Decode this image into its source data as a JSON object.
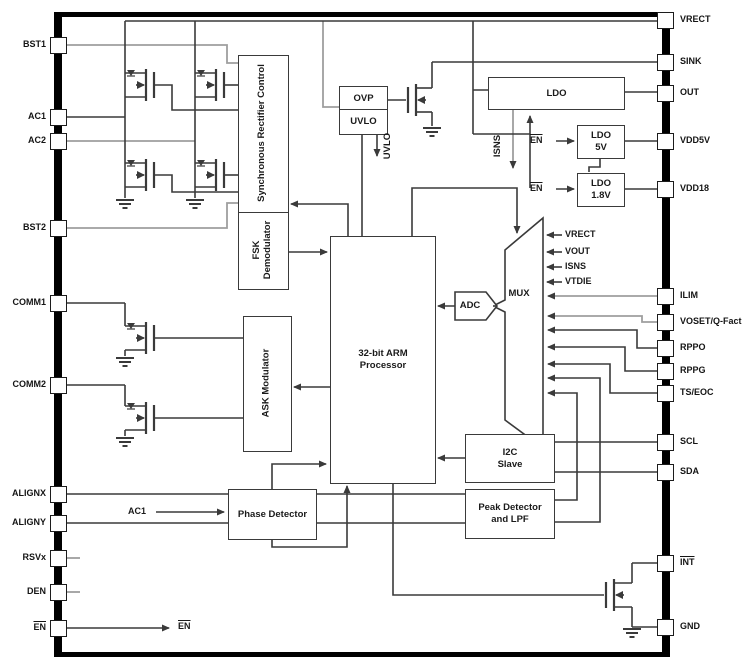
{
  "colors": {
    "line": "#3a3a3a",
    "gray": "#9e9e9e",
    "text": "#1a1a1a",
    "frame": "#000000"
  },
  "pins": {
    "left": [
      {
        "label": "BST1",
        "y": 45,
        "overline": false
      },
      {
        "label": "AC1",
        "y": 117,
        "overline": false
      },
      {
        "label": "AC2",
        "y": 141,
        "overline": false
      },
      {
        "label": "BST2",
        "y": 228,
        "overline": false
      },
      {
        "label": "COMM1",
        "y": 303,
        "overline": false
      },
      {
        "label": "COMM2",
        "y": 385,
        "overline": false
      },
      {
        "label": "ALIGNX",
        "y": 494,
        "overline": false
      },
      {
        "label": "ALIGNY",
        "y": 523,
        "overline": false
      },
      {
        "label": "RSVx",
        "y": 558,
        "overline": false
      },
      {
        "label": "DEN",
        "y": 592,
        "overline": false
      },
      {
        "label": "EN",
        "y": 628,
        "overline": true
      }
    ],
    "right": [
      {
        "label": "VRECT",
        "y": 20,
        "overline": false
      },
      {
        "label": "SINK",
        "y": 62,
        "overline": false
      },
      {
        "label": "OUT",
        "y": 93,
        "overline": false
      },
      {
        "label": "VDD5V",
        "y": 141,
        "overline": false
      },
      {
        "label": "VDD18",
        "y": 189,
        "overline": false
      },
      {
        "label": "ILIM",
        "y": 296,
        "overline": false
      },
      {
        "label": "VOSET/Q-Fact",
        "y": 322,
        "overline": false
      },
      {
        "label": "RPPO",
        "y": 348,
        "overline": false
      },
      {
        "label": "RPPG",
        "y": 371,
        "overline": false
      },
      {
        "label": "TS/EOC",
        "y": 393,
        "overline": false
      },
      {
        "label": "SCL",
        "y": 442,
        "overline": false
      },
      {
        "label": "SDA",
        "y": 472,
        "overline": false
      },
      {
        "label": "INT",
        "y": 563,
        "overline": true
      },
      {
        "label": "GND",
        "y": 627,
        "overline": false
      }
    ]
  },
  "blocks": {
    "sync_rect": "Synchronous Rectifier Control",
    "fsk": {
      "line1": "FSK",
      "line2": "Demodulator"
    },
    "ovp": "OVP",
    "uvlo": "UVLO",
    "ldo": "LDO",
    "ldo5v": {
      "line1": "LDO",
      "line2": "5V"
    },
    "ldo18v": {
      "line1": "LDO",
      "line2": "1.8V"
    },
    "arm": {
      "line1": "32-bit ARM",
      "line2": "Processor"
    },
    "ask": "ASK Modulator",
    "i2c": {
      "line1": "I2C",
      "line2": "Slave"
    },
    "peak": {
      "line1": "Peak Detector",
      "line2": "and LPF"
    },
    "phase": "Phase Detector",
    "mux": "MUX",
    "adc": "ADC"
  },
  "signals": {
    "uvlo": "UVLO",
    "isns": "ISNS",
    "ac1": "AC1",
    "en": "EN",
    "mux_inputs": [
      "VRECT",
      "VOUT",
      "ISNS",
      "VTDIE"
    ]
  }
}
